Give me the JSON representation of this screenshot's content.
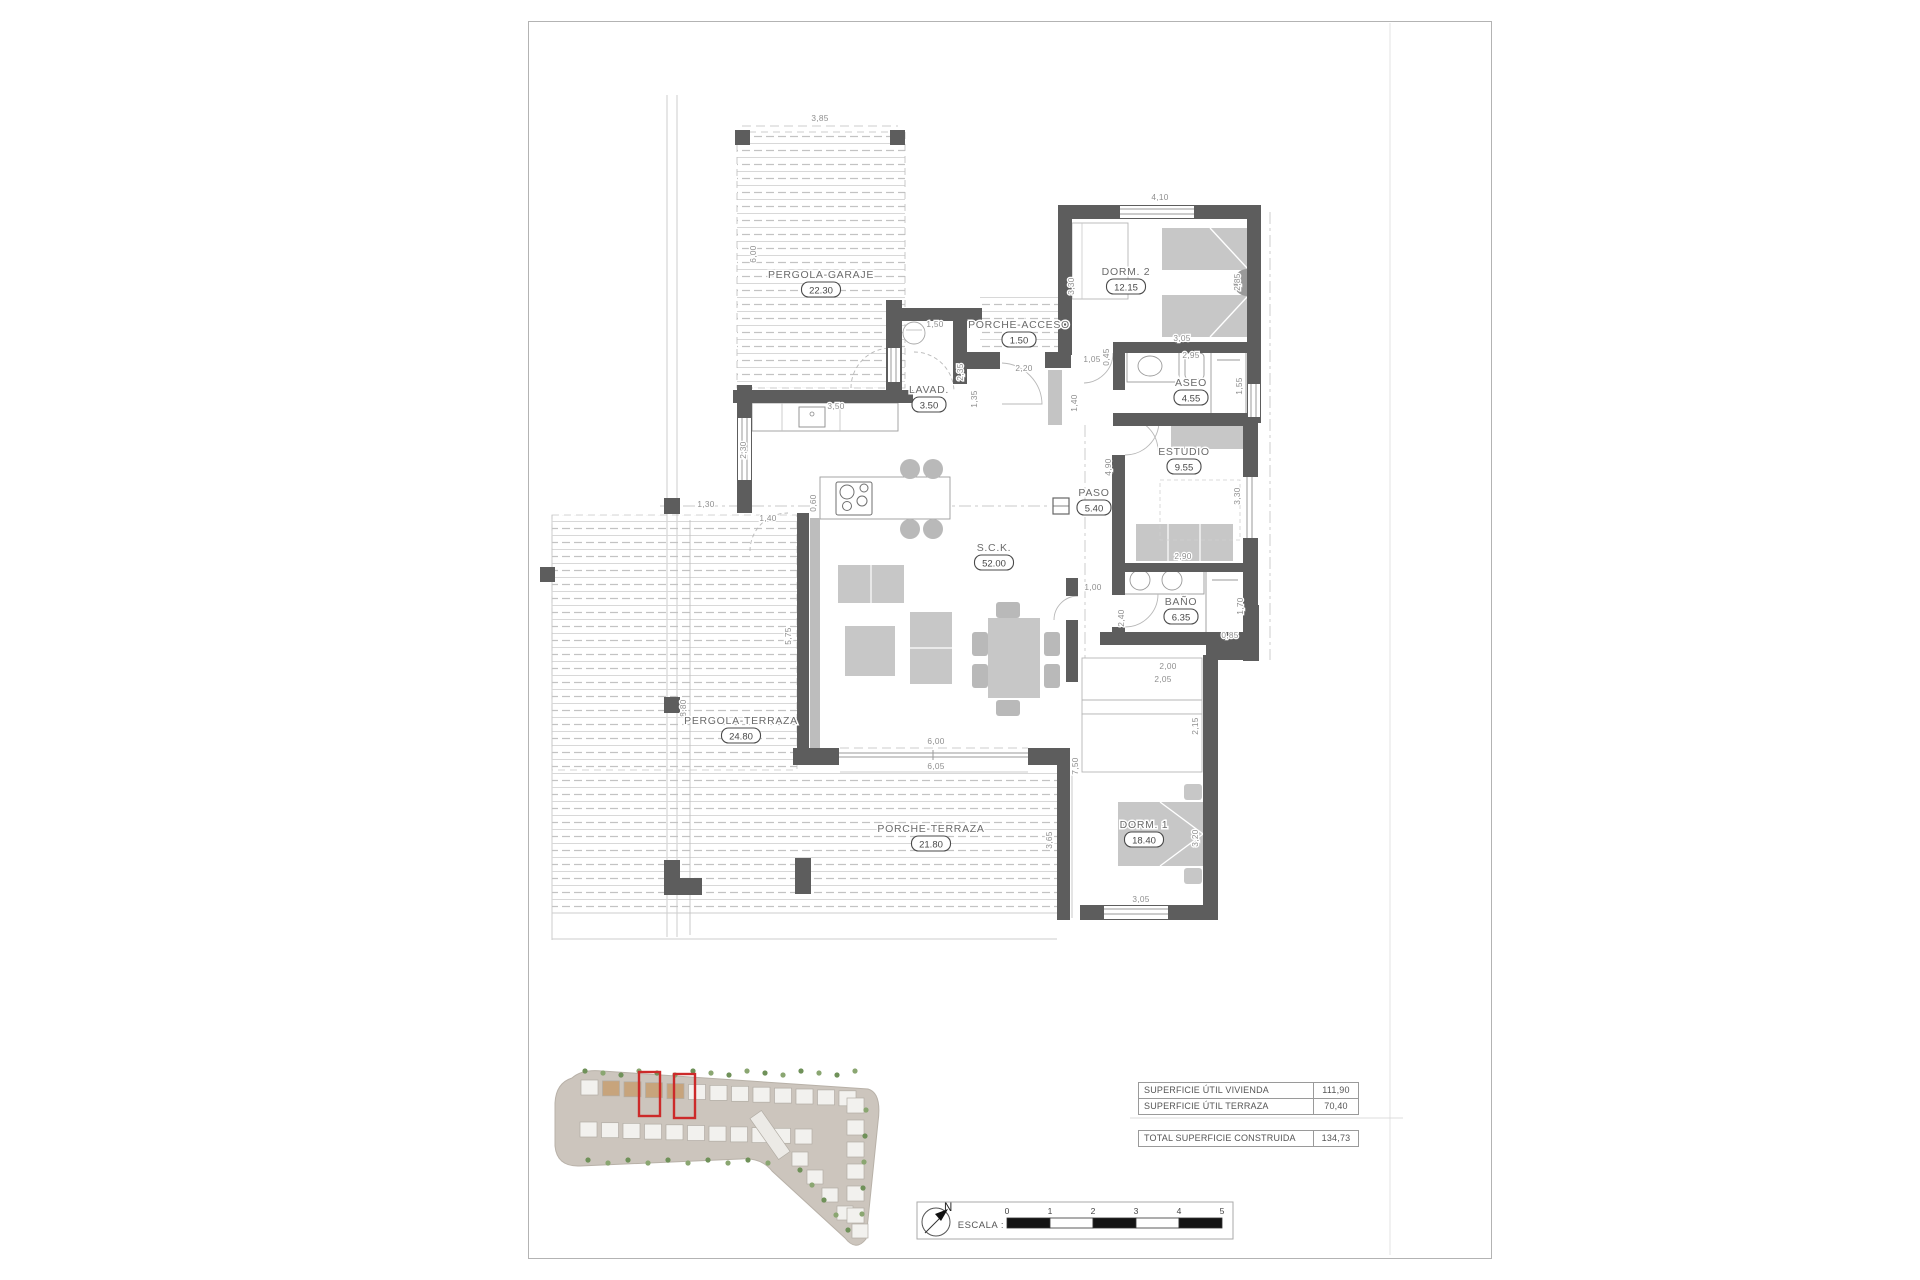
{
  "plan": {
    "rooms": [
      {
        "name": "PERGOLA-GARAJE",
        "area": "22.30",
        "x": 821,
        "y": 278
      },
      {
        "name": "PORCHE-ACCESO",
        "area": "1.50",
        "x": 1019,
        "y": 328
      },
      {
        "name": "LAVAD.",
        "area": "3.50",
        "x": 929,
        "y": 393
      },
      {
        "name": "DORM. 2",
        "area": "12.15",
        "x": 1126,
        "y": 275
      },
      {
        "name": "ASEO",
        "area": "4.55",
        "x": 1191,
        "y": 386
      },
      {
        "name": "ESTUDIO",
        "area": "9.55",
        "x": 1184,
        "y": 455
      },
      {
        "name": "PASO",
        "area": "5.40",
        "x": 1094,
        "y": 496
      },
      {
        "name": "S.C.K.",
        "area": "52.00",
        "x": 994,
        "y": 551
      },
      {
        "name": "BAÑO",
        "area": "6.35",
        "x": 1181,
        "y": 605
      },
      {
        "name": "PERGOLA-TERRAZA",
        "area": "24.80",
        "x": 741,
        "y": 724
      },
      {
        "name": "PORCHE-TERRAZA",
        "area": "21.80",
        "x": 931,
        "y": 832
      },
      {
        "name": "DORM. 1",
        "area": "18.40",
        "x": 1144,
        "y": 828
      }
    ],
    "dimensions": [
      {
        "t": "3,85",
        "x": 820,
        "y": 121,
        "v": 0
      },
      {
        "t": "6,00",
        "x": 756,
        "y": 254,
        "v": 1
      },
      {
        "t": "1,50",
        "x": 935,
        "y": 327,
        "v": 0
      },
      {
        "t": "2,35",
        "x": 963,
        "y": 372,
        "v": 1
      },
      {
        "t": "1,35",
        "x": 977,
        "y": 399,
        "v": 1
      },
      {
        "t": "2,20",
        "x": 1024,
        "y": 371,
        "v": 0
      },
      {
        "t": "3,50",
        "x": 836,
        "y": 409,
        "v": 0
      },
      {
        "t": "2,30",
        "x": 746,
        "y": 450,
        "v": 1
      },
      {
        "t": "1,05",
        "x": 1092,
        "y": 362,
        "v": 0
      },
      {
        "t": "0,45",
        "x": 1109,
        "y": 357,
        "v": 1
      },
      {
        "t": "1,40",
        "x": 1077,
        "y": 403,
        "v": 1
      },
      {
        "t": "3,30",
        "x": 1074,
        "y": 286,
        "v": 1
      },
      {
        "t": "4,10",
        "x": 1160,
        "y": 200,
        "v": 0
      },
      {
        "t": "2,85",
        "x": 1240,
        "y": 282,
        "v": 1
      },
      {
        "t": "3,05",
        "x": 1182,
        "y": 341,
        "v": 0
      },
      {
        "t": "2,95",
        "x": 1191,
        "y": 358,
        "v": 0
      },
      {
        "t": "1,55",
        "x": 1242,
        "y": 386,
        "v": 1
      },
      {
        "t": "4,90",
        "x": 1111,
        "y": 467,
        "v": 1
      },
      {
        "t": "3,30",
        "x": 1240,
        "y": 496,
        "v": 1
      },
      {
        "t": "2,90",
        "x": 1183,
        "y": 559,
        "v": 0
      },
      {
        "t": "1,70",
        "x": 1243,
        "y": 606,
        "v": 1
      },
      {
        "t": "0,85",
        "x": 1230,
        "y": 638,
        "v": 0
      },
      {
        "t": "2,40",
        "x": 1124,
        "y": 618,
        "v": 1
      },
      {
        "t": "1,00",
        "x": 1093,
        "y": 590,
        "v": 0
      },
      {
        "t": "2,00",
        "x": 1168,
        "y": 669,
        "v": 0
      },
      {
        "t": "2,05",
        "x": 1163,
        "y": 682,
        "v": 0
      },
      {
        "t": "2,15",
        "x": 1198,
        "y": 726,
        "v": 1
      },
      {
        "t": "3,20",
        "x": 1198,
        "y": 838,
        "v": 1
      },
      {
        "t": "3,05",
        "x": 1141,
        "y": 902,
        "v": 0
      },
      {
        "t": "7,50",
        "x": 1078,
        "y": 766,
        "v": 1
      },
      {
        "t": "3,65",
        "x": 1052,
        "y": 840,
        "v": 1
      },
      {
        "t": "6,00",
        "x": 936,
        "y": 744,
        "v": 0
      },
      {
        "t": "6,05",
        "x": 936,
        "y": 769,
        "v": 0
      },
      {
        "t": "5,75",
        "x": 791,
        "y": 636,
        "v": 1
      },
      {
        "t": "8,80",
        "x": 686,
        "y": 708,
        "v": 1
      },
      {
        "t": "1,30",
        "x": 706,
        "y": 507,
        "v": 0
      },
      {
        "t": "1,40",
        "x": 768,
        "y": 521,
        "v": 0
      },
      {
        "t": "0,60",
        "x": 816,
        "y": 503,
        "v": 1
      }
    ]
  },
  "summary": {
    "rows": [
      {
        "label": "SUPERFICIE ÚTIL VIVIENDA",
        "value": "111,90"
      },
      {
        "label": "SUPERFICIE ÚTIL TERRAZA",
        "value": "70,40"
      }
    ],
    "total": {
      "label": "TOTAL SUPERFICIE CONSTRUIDA",
      "value": "134,73"
    }
  },
  "titleblock": {
    "compass_label": "N",
    "scale_label": "ESCALA :",
    "scale_ticks": [
      "0",
      "1",
      "2",
      "3",
      "4",
      "5"
    ]
  },
  "colors": {
    "wall": "#5d5d5d",
    "furniture": "#c7c7c7",
    "highlight": "#cc2a2a",
    "site_ground": "#ccc5bd",
    "site_green": "#8aa671"
  }
}
